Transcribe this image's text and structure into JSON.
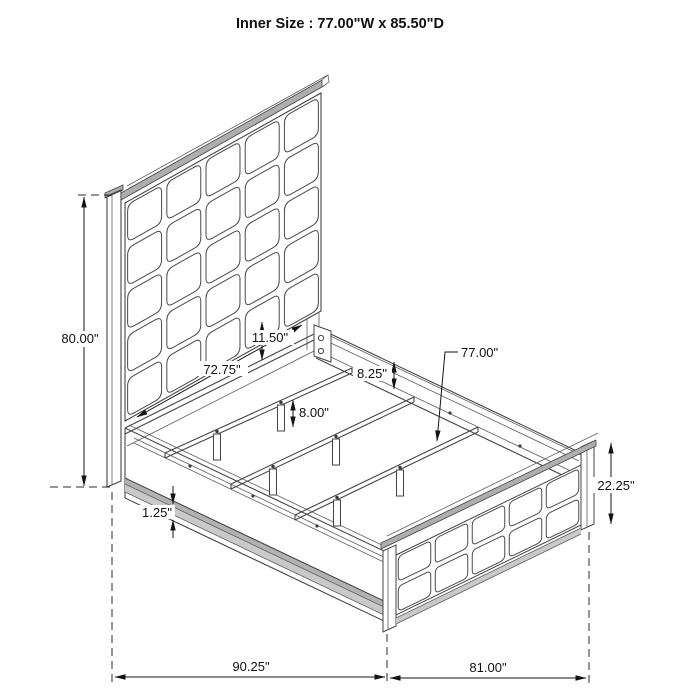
{
  "title": "Inner Size : 77.00\"W x 85.50\"D",
  "dimensions": {
    "headboard_height": "80.00\"",
    "side_rail_length": "72.75\"",
    "headboard_bottom_gap": "11.50\"",
    "side_rail_height": "8.25\"",
    "support_leg_height": "8.00\"",
    "slat_width": "77.00\"",
    "footboard_height": "22.25\"",
    "base_trim_thickness": "1.25\"",
    "overall_depth": "90.25\"",
    "overall_width": "81.00\""
  }
}
